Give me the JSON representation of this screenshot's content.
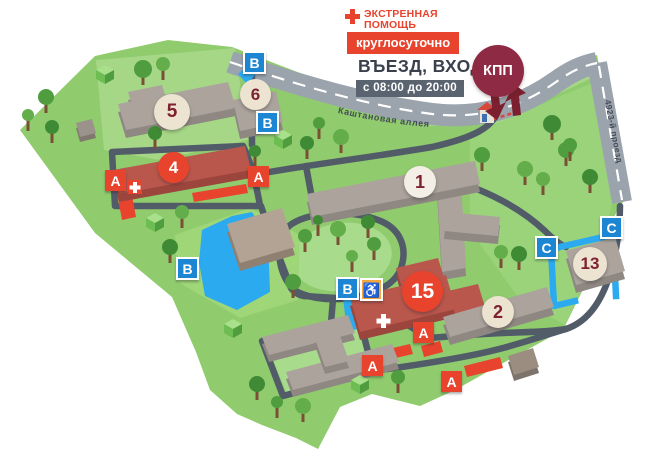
{
  "header": {
    "emergency_line1": "ЭКСТРЕННАЯ",
    "emergency_line2": "ПОМОЩЬ",
    "round_the_clock": "круглосуточно",
    "entrance": "ВЪЕЗД, ВХОД",
    "hours": "с 08:00 до 20:00",
    "checkpoint_label": "КПП"
  },
  "streets": {
    "chestnut_alley": "Каштановая аллея",
    "passage_4923": "4923-й проезд"
  },
  "buildings": {
    "b1": "1",
    "b2": "2",
    "b4": "4",
    "b5": "5",
    "b6": "6",
    "b13": "13",
    "b15": "15"
  },
  "zones": {
    "a": "А",
    "b": "В",
    "c": "С"
  },
  "icons": {
    "wheelchair": "♿"
  },
  "colors": {
    "accent_red": "#e8432d",
    "marker_blue": "#1d86d3",
    "checkpoint_maroon": "#8e2a43",
    "dark_text": "#3a414d",
    "hours_bg": "#5a6370",
    "pond_blue": "#2baaf0",
    "map_green": "#90cb6e"
  }
}
